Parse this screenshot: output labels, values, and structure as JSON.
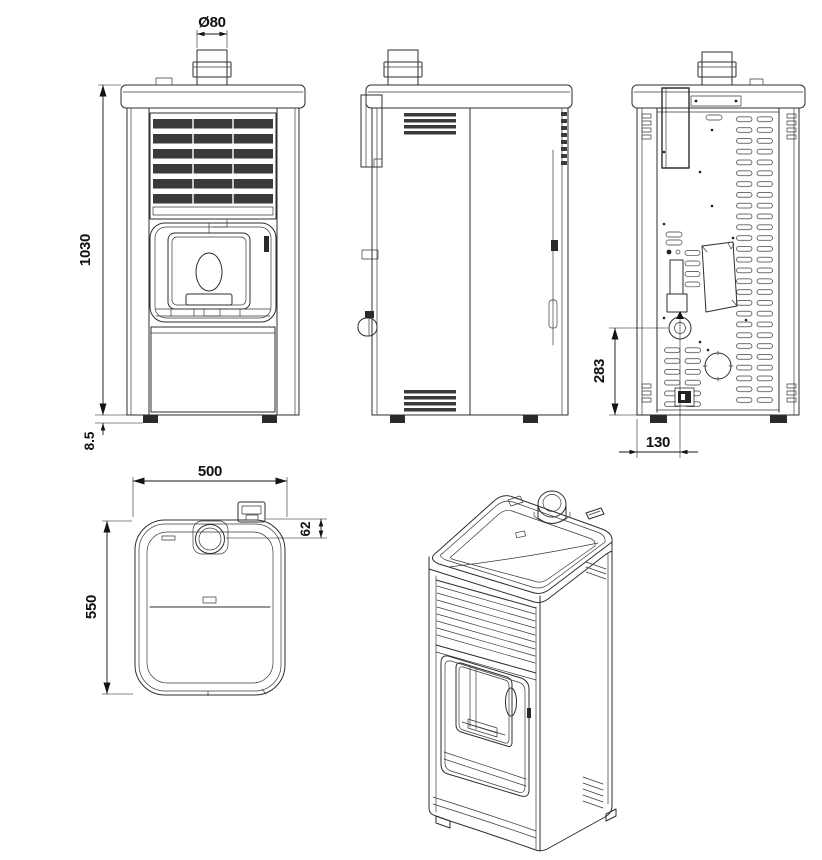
{
  "drawing": {
    "subject": "pellet-stove-technical-drawing",
    "style": {
      "background": "#ffffff",
      "line_color": "#2e2e2e",
      "dimension_color": "#141414",
      "louver_fill": "#3a3a3a"
    },
    "dimensions": {
      "flue_diameter": "Ø80",
      "overall_height": "1030",
      "foot_height": "8.5",
      "air_inlet_height": "283",
      "air_inlet_offset": "130",
      "width": "500",
      "depth": "550",
      "flue_offset_from_back": "62"
    }
  }
}
